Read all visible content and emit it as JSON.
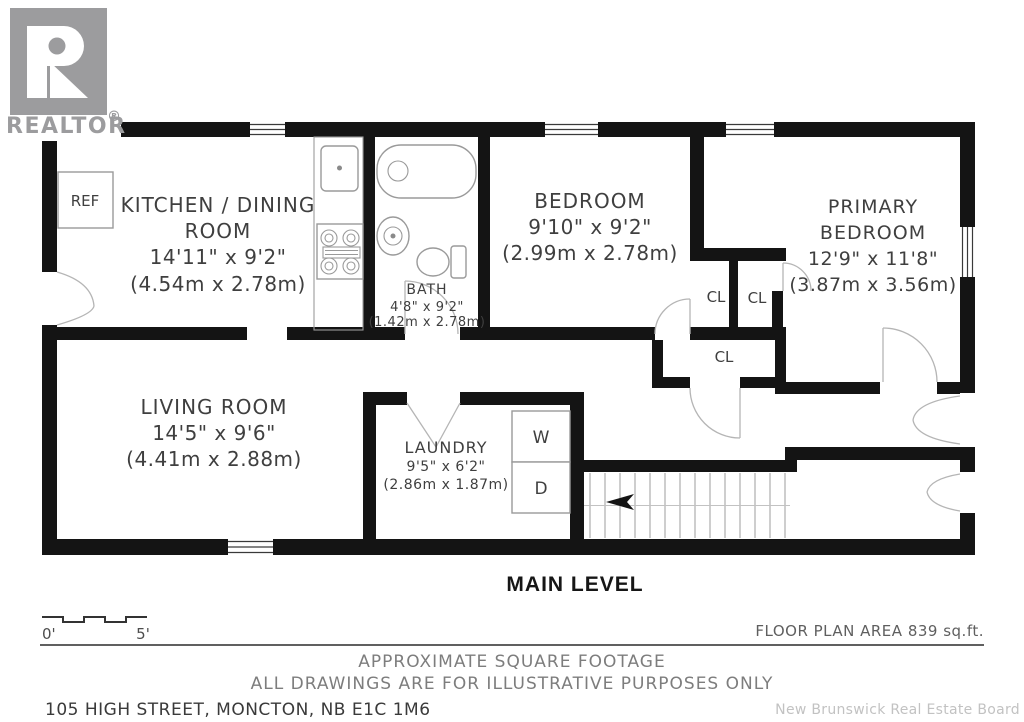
{
  "branding": {
    "logo_text": "REALTOR",
    "registered_mark": "®",
    "board_attribution": "New Brunswick Real Estate Board"
  },
  "plan": {
    "level_label": "MAIN LEVEL",
    "floor_area_label": "FLOOR PLAN AREA 839 sq.ft.",
    "rooms": {
      "kitchen": {
        "lines": [
          "KITCHEN / DINING",
          "ROOM",
          "14'11\" x 9'2\"",
          "(4.54m x 2.78m)"
        ]
      },
      "bath": {
        "lines": [
          "BATH",
          "4'8\" x 9'2\"",
          "(1.42m x 2.78m)"
        ]
      },
      "bedroom": {
        "lines": [
          "BEDROOM",
          "9'10\" x 9'2\"",
          "(2.99m x 2.78m)"
        ]
      },
      "primary_bedroom": {
        "lines": [
          "PRIMARY",
          "BEDROOM",
          "12'9\" x 11'8\"",
          "(3.87m x 3.56m)"
        ]
      },
      "living_room": {
        "lines": [
          "LIVING ROOM",
          "14'5\" x 9'6\"",
          "(4.41m x 2.88m)"
        ]
      },
      "laundry": {
        "lines": [
          "LAUNDRY",
          "9'5\" x 6'2\"",
          "(2.86m x 1.87m)"
        ]
      }
    },
    "closets": {
      "cl1": "CL",
      "cl2": "CL",
      "cl3": "CL"
    },
    "fixtures": {
      "fridge": "REF",
      "washer": "W",
      "dryer": "D"
    },
    "scale_bar": {
      "start_label": "0'",
      "end_label": "5'"
    }
  },
  "footer": {
    "disclaimer_line1": "APPROXIMATE SQUARE FOOTAGE",
    "disclaimer_line2": "ALL DRAWINGS ARE FOR ILLUSTRATIVE PURPOSES ONLY",
    "address": "105 HIGH STREET, MONCTON, NB E1C 1M6"
  },
  "colors": {
    "wall": "#141414",
    "label_text": "#3f3f3f",
    "muted_text": "#7d7d7d",
    "attribution_text": "#c2c2c2",
    "logo_gray": "#9c9c9e",
    "door_arc": "#b5b5b5",
    "fixture_stroke": "#9a9a9a"
  }
}
